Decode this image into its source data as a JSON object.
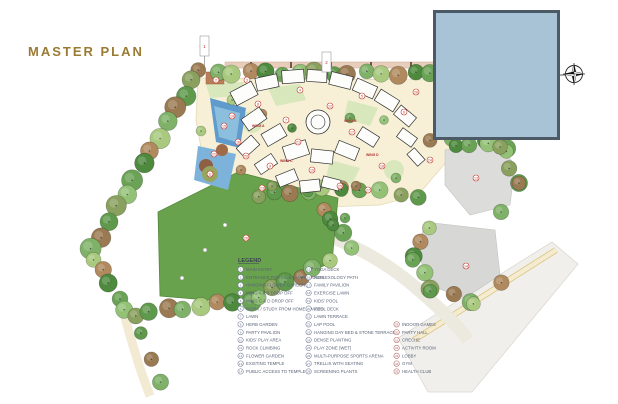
{
  "title": "MASTER PLAN",
  "colors": {
    "title_gold": "#9a7b33",
    "overlay_blue": "#a9c3d6",
    "overlay_border": "#4b5a66",
    "field_green": "#69a24c",
    "pool_blue": "#5f9bcd",
    "path_cream": "#f7f0d6",
    "legend_text": "#5a6378",
    "legend_circle_blue": "#6b7693",
    "legend_circle_red": "#b05a5a",
    "marker_red": "#c0392b"
  },
  "legend": {
    "header": "LEGEND",
    "columns": [
      {
        "circle_color": "#6b7693",
        "items": [
          {
            "num": "1",
            "label": "MAIN ENTRY"
          },
          {
            "num": "2",
            "label": "ENTRANCE PORTAL & GUARD HOUSE"
          },
          {
            "num": "3",
            "label": "HANGING FLOWER GARDEN"
          },
          {
            "num": "4",
            "label": "WING A & B DROP OFF"
          },
          {
            "num": "5",
            "label": "WING C & D DROP OFF"
          },
          {
            "num": "6",
            "label": "WORK / STUDY FROM HOME SPACES"
          },
          {
            "num": "7",
            "label": "LAWN"
          },
          {
            "num": "8",
            "label": "HERB GARDEN"
          },
          {
            "num": "9",
            "label": "PARTY PAVILION"
          },
          {
            "num": "10",
            "label": "KIDS' PLAY AREA"
          },
          {
            "num": "11",
            "label": "ROCK CLIMBING"
          },
          {
            "num": "12",
            "label": "FLOWER GARDEN"
          },
          {
            "num": "13",
            "label": "EXISTING TEMPLE"
          },
          {
            "num": "14",
            "label": "PUBLIC ACCESS TO TEMPLE"
          }
        ]
      },
      {
        "circle_color": "#6b7693",
        "items": [
          {
            "num": "15",
            "label": "YOGA DECK"
          },
          {
            "num": "16",
            "label": "REFLEXOLOGY PATH"
          },
          {
            "num": "17",
            "label": "FAMILY PAVILION"
          },
          {
            "num": "18",
            "label": "EXERCISE LAWN"
          },
          {
            "num": "19",
            "label": "KIDS' POOL"
          },
          {
            "num": "20",
            "label": "POOL DECK"
          },
          {
            "num": "21",
            "label": "LAWN TERRACE"
          },
          {
            "num": "22",
            "label": "LAP POOL"
          },
          {
            "num": "23",
            "label": "HANGING DAY BED & STONE TERRACE"
          },
          {
            "num": "24",
            "label": "DENSE PLANTING"
          },
          {
            "num": "25",
            "label": "PLAY ZONE (WET)"
          },
          {
            "num": "26",
            "label": "MULTI-PURPOSE SPORTS ARENA"
          },
          {
            "num": "27",
            "label": "TRELLIS WITH SEATING"
          },
          {
            "num": "28",
            "label": "SCREENING PLANTS"
          }
        ]
      },
      {
        "circle_color": "#b05a5a",
        "items": [
          {
            "num": "29",
            "label": "INDOOR GAMES"
          },
          {
            "num": "30",
            "label": "PARTY HALL"
          },
          {
            "num": "31",
            "label": "CRECHE"
          },
          {
            "num": "32",
            "label": "ACTIVITY ROOM"
          },
          {
            "num": "33",
            "label": "LOBBY"
          },
          {
            "num": "34",
            "label": "GYM"
          },
          {
            "num": "35",
            "label": "HEALTH CLUB"
          }
        ]
      }
    ]
  },
  "plan": {
    "wing_labels": [
      {
        "text": "WING A",
        "x": 252,
        "y": 127
      },
      {
        "text": "WING B",
        "x": 344,
        "y": 122
      },
      {
        "text": "WING C",
        "x": 280,
        "y": 162
      },
      {
        "text": "WING D",
        "x": 366,
        "y": 156
      }
    ],
    "markers": [
      {
        "n": "1",
        "x": 203,
        "y": 46
      },
      {
        "n": "2",
        "x": 216,
        "y": 80
      },
      {
        "n": "3",
        "x": 247,
        "y": 80
      },
      {
        "n": "4",
        "x": 300,
        "y": 90
      },
      {
        "n": "5",
        "x": 362,
        "y": 96
      },
      {
        "n": "6",
        "x": 404,
        "y": 112
      },
      {
        "n": "7",
        "x": 286,
        "y": 120
      },
      {
        "n": "8",
        "x": 258,
        "y": 104
      },
      {
        "n": "9",
        "x": 270,
        "y": 166
      },
      {
        "n": "10",
        "x": 312,
        "y": 170
      },
      {
        "n": "11",
        "x": 210,
        "y": 174
      },
      {
        "n": "12",
        "x": 330,
        "y": 106
      },
      {
        "n": "13",
        "x": 476,
        "y": 178
      },
      {
        "n": "14",
        "x": 466,
        "y": 266
      },
      {
        "n": "15",
        "x": 224,
        "y": 126
      },
      {
        "n": "16",
        "x": 238,
        "y": 142
      },
      {
        "n": "17",
        "x": 352,
        "y": 132
      },
      {
        "n": "18",
        "x": 382,
        "y": 166
      },
      {
        "n": "19",
        "x": 232,
        "y": 116
      },
      {
        "n": "20",
        "x": 246,
        "y": 156
      },
      {
        "n": "21",
        "x": 298,
        "y": 142
      },
      {
        "n": "22",
        "x": 214,
        "y": 154
      },
      {
        "n": "23",
        "x": 262,
        "y": 188
      },
      {
        "n": "24",
        "x": 430,
        "y": 160
      },
      {
        "n": "25",
        "x": 340,
        "y": 186
      },
      {
        "n": "26",
        "x": 246,
        "y": 238
      },
      {
        "n": "27",
        "x": 368,
        "y": 190
      },
      {
        "n": "28",
        "x": 416,
        "y": 92
      }
    ],
    "flag_markers": [
      {
        "n": "1",
        "x": 200,
        "y": 36
      },
      {
        "n": "2",
        "x": 322,
        "y": 52
      }
    ]
  }
}
